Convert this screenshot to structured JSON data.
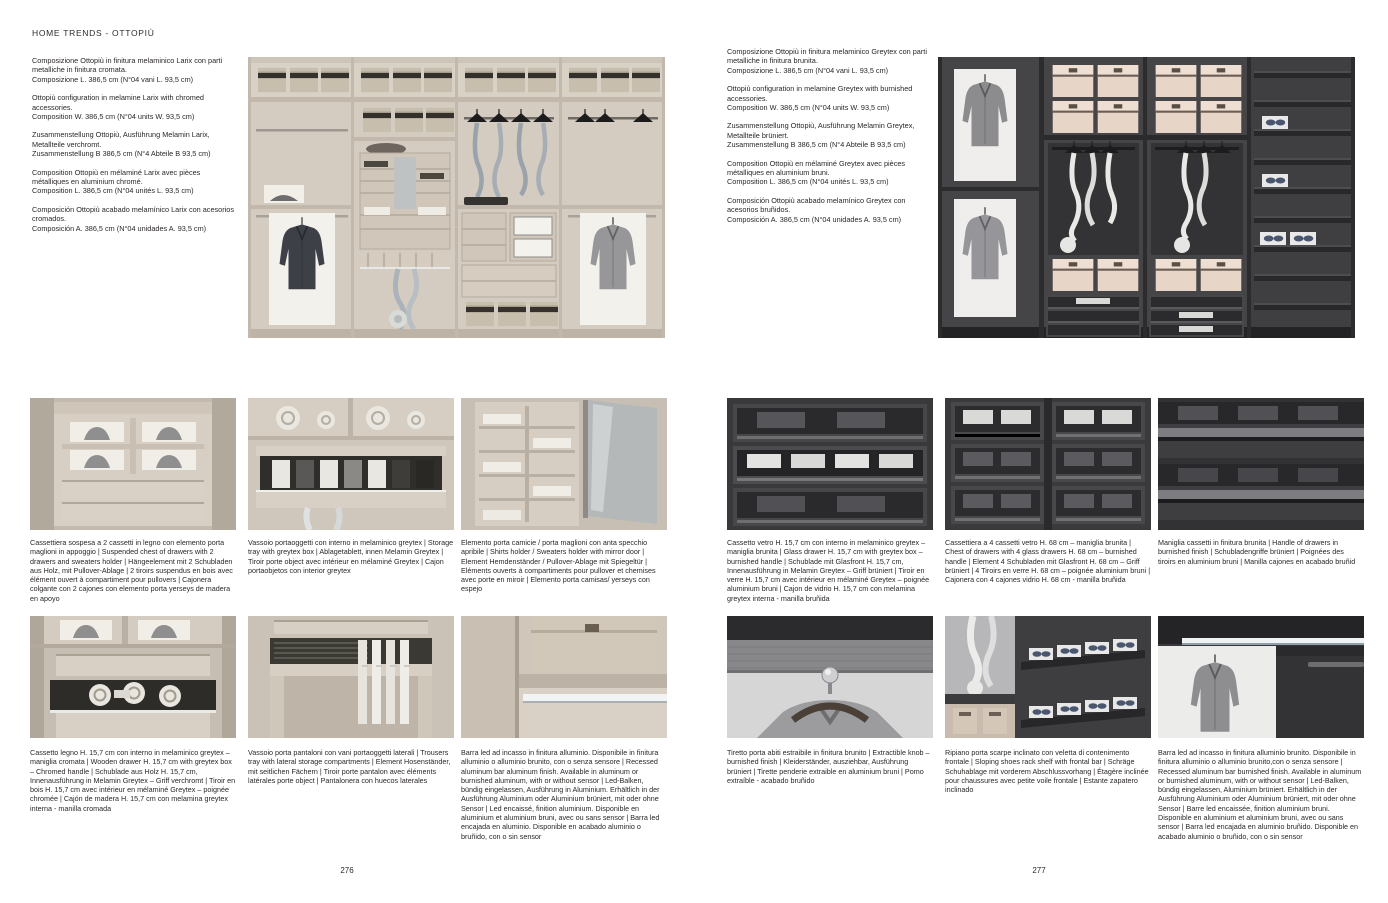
{
  "header": {
    "title": "HOME TRENDS - OTTOPIÙ"
  },
  "palette": {
    "paper": "#ffffff",
    "text": "#2b2826",
    "wood_light": "#d6cec2",
    "finish_dark": "#3a3a3c"
  },
  "pages": [
    {
      "number": "276",
      "intro": [
        "Composizione Ottopiù in finitura melaminico Larix con parti metalliche in finitura cromata.\nComposizione L. 386,5 cm (N°04 vani L. 93,5 cm)",
        "Ottopiù configuration in melamine Larix with chromed accessories.\nComposition W. 386,5 cm (N°04 units W. 93,5 cm)",
        "Zusammenstellung Ottopiù, Ausführung Melamin Larix, Metallteile verchromt.\nZusammenstellung B 386,5 cm (N°4 Abteile B 93,5 cm)",
        "Composition Ottopiù en mélaminé Larix avec pièces métalliques en aluminium chromé.\nComposition L. 386,5 cm (N°04 unités L. 93,5 cm)",
        "Composición Ottopiù acabado melamínico Larix con acesorios cromados.\nComposición A. 386,5 cm (N°04 unidades A. 93,5 cm)"
      ],
      "captions": [
        "Cassettiera sospesa a 2 cassetti in legno con elemento porta maglioni in appoggio | Suspended chest of drawers with 2 drawers and sweaters holder | Hängeelement mit 2 Schubladen aus Holz, mit Pullover-Ablage | 2 tiroirs suspendus en bois avec élément ouvert à compartiment pour pullovers | Cajonera colgante con 2 cajones con elemento porta yerseys de madera en apoyo",
        "Vassoio portaoggetti con interno in melaminico greytex | Storage tray with greytex box | Ablagetablett, innen Melamin Greytex | Tiroir porte object avec intérieur en mélaminé Greytex | Cajon portaobjetos con interior greytex",
        "Elemento porta camicie / porta maglioni con anta specchio apribile | Shirts holder / Sweaters holder with mirror door | Element Hemdenständer / Pullover-Ablage mit Spiegeltür | Eléments ouverts à compartiments pour pullover et chemises avec porte en miroir | Elemento porta camisas/ yerseys con espejo",
        "Cassetto legno H. 15,7 cm con interno in melaminico greytex – maniglia cromata | Wooden drawer H. 15,7 cm with greytex box – Chromed handle | Schublade aus Holz H. 15,7 cm, Innenausführung in Melamin Greytex – Griff verchromt | Tiroir en bois H. 15,7 cm avec intérieur en mélaminé Greytex – poignée chromée | Cajón de madera H. 15,7 cm con melamina greytex interna - manilla cromada",
        "Vassoio porta pantaloni con vani portaoggetti laterali | Trousers tray with lateral storage compartments | Element Hosenständer, mit seitlichen Fächern | Tiroir porte pantalon avec éléments latérales porte object | Pantalonera con huecos laterales",
        "Barra led ad incasso in finitura alluminio. Disponibile in finitura alluminio o alluminio brunito, con o senza sensore | Recessed aluminum bar aluminum finish. Available in aluminum or burnished aluminum, with or without sensor | Led-Balken, bündig eingelassen, Ausführung in Aluminium. Erhältlich in der Ausführung Aluminium oder Aluminium brüniert, mit oder ohne Sensor | Led encaissé, finition aluminium. Disponible en aluminium et aluminium bruni, avec ou sans sensor | Barra led encajada en aluminio. Disponible en acabado aluminio o bruñido, con o sin sensor"
      ]
    },
    {
      "number": "277",
      "intro": [
        "Composizione Ottopiù in finitura melaminico Greytex con parti metalliche in finitura brunita.\nComposizione L. 386,5 cm (N°04 vani L. 93,5 cm)",
        "Ottopiù configuration in melamine Greytex with burnished accessories.\nComposition W. 386,5 cm (N°04 units W. 93,5 cm)",
        "Zusammenstellung Ottopiù, Ausführung Melamin Greytex, Metallteile brüniert.\nZusammenstellung B 386,5 cm (N°4 Abteile B 93,5 cm)",
        "Composition Ottopiù en mélaminé Greytex avec pièces métalliques en aluminium bruni.\nComposition L. 386,5 cm (N°04 unités L. 93,5 cm)",
        "Composición Ottopiù acabado melamínico Greytex con acesorios bruñidos.\nComposición A. 386,5 cm (N°04 unidades A. 93,5 cm)"
      ],
      "captions": [
        "Cassetto vetro H. 15,7 cm con interno in melaminico greytex – maniglia brunita | Glass drawer H. 15,7 cm with greytex box – burnished handle | Schublade mit Glasfront H. 15,7 cm, Innenausführung in Melamin Greytex – Griff brüniert | Tiroir en verre H. 15,7 cm avec intérieur en mélaminé Greytex – poignée aluminium bruni | Cajon de vidrio H. 15,7 cm con melamina greytex interna - manilla bruñida",
        "Cassettiera a 4 cassetti vetro H. 68 cm – maniglia brunita | Chest of drawers with 4 glass drawers H. 68 cm – burnished handle | Element 4 Schubladen mit Glasfront H. 68 cm – Griff brüniert | 4 Tiroirs en verre H. 68 cm – poignée aluminium bruni | Cajonera con 4 cajones vidrio H. 68 cm - manilla bruñida",
        "Maniglia cassetti in finitura brunita | Handle of drawers in burnished finish | Schubladengriffe brüniert | Poignées des tiroirs en aluminium bruni | Manilla cajones en acabado bruñid",
        "Tiretto porta abiti estraibile in finitura brunito | Extractible knob – burnished finish | Kleiderständer, ausziehbar, Ausführung brüniert | Tirette penderie extraible en aluminium bruni | Pomo extraíble - acabado bruñido",
        "Ripiano porta scarpe inclinato con veletta di contenimento frontale | Sloping shoes rack shelf with frontal bar | Schräge Schuhablage mit vorderem Abschlussvorhang | Étagère inclinée pour chaussures avec petite voile frontale | Estante zapatero inclinado",
        "Barra led ad incasso in finitura alluminio brunito. Disponibile in finitura alluminio o alluminio brunito,con o senza sensore | Recessed aluminum bar burnished finish. Available in aluminum or burnished aluminum, with or without sensor | Led-Balken, bündig eingelassen, Aluminium brüniert. Erhältlich in der Ausführung Aluminium oder Aluminium brüniert, mit oder ohne Sensor | Barre led encaissée, finition aluminium bruni. Disponible en aluminium et aluminium bruni, avec ou sans sensor | Barra led encajada en aluminio bruñido. Disponible en acabado aluminio o bruñido, con o sin sensor"
      ]
    }
  ]
}
